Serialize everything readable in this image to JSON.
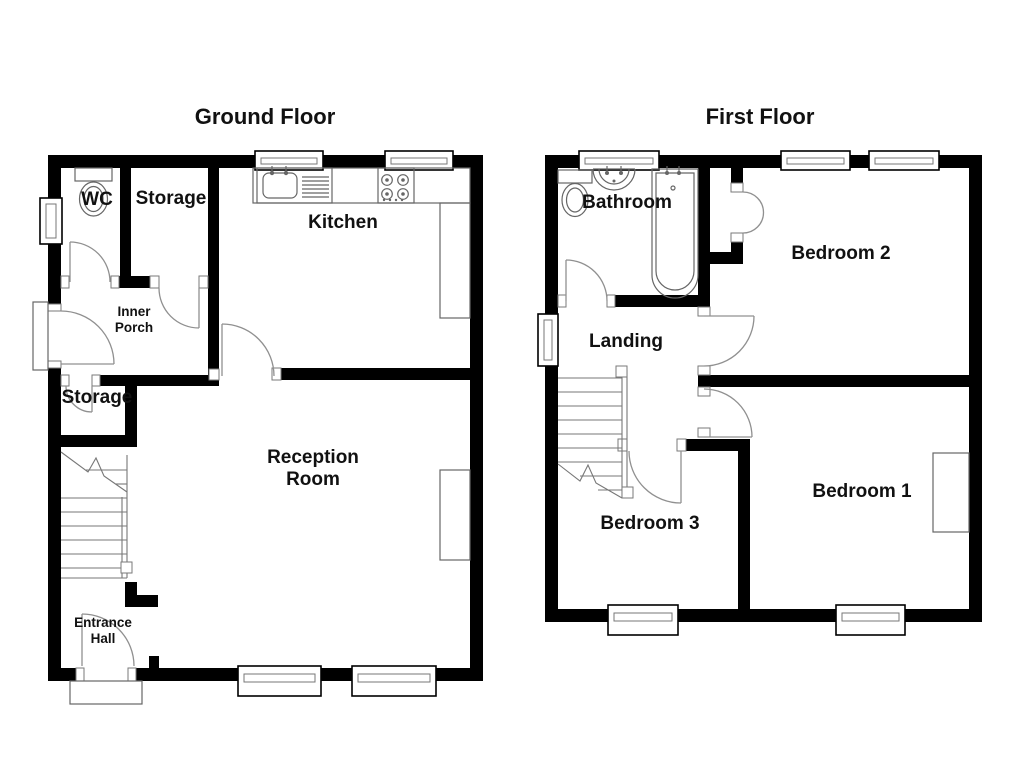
{
  "page": {
    "background": "#ffffff"
  },
  "colors": {
    "wall": "#000000",
    "fixture_line": "#666666",
    "door_line": "#909090",
    "text": "#111111"
  },
  "floors": {
    "ground": {
      "title": "Ground Floor",
      "rooms": {
        "wc": "WC",
        "storage_top": "Storage",
        "kitchen": "Kitchen",
        "inner_porch_line1": "Inner",
        "inner_porch_line2": "Porch",
        "storage_lower": "Storage",
        "reception_line1": "Reception",
        "reception_line2": "Room",
        "entrance_line1": "Entrance",
        "entrance_line2": "Hall"
      },
      "fixtures": [
        "toilet",
        "kitchen-sink",
        "stove",
        "staircase",
        "fireplace"
      ]
    },
    "first": {
      "title": "First Floor",
      "rooms": {
        "bathroom": "Bathroom",
        "bedroom2": "Bedroom 2",
        "landing": "Landing",
        "bedroom3": "Bedroom 3",
        "bedroom1": "Bedroom 1"
      },
      "fixtures": [
        "toilet",
        "washbasin",
        "bathtub",
        "airing-cupboard",
        "staircase",
        "chimney-breast"
      ]
    }
  }
}
